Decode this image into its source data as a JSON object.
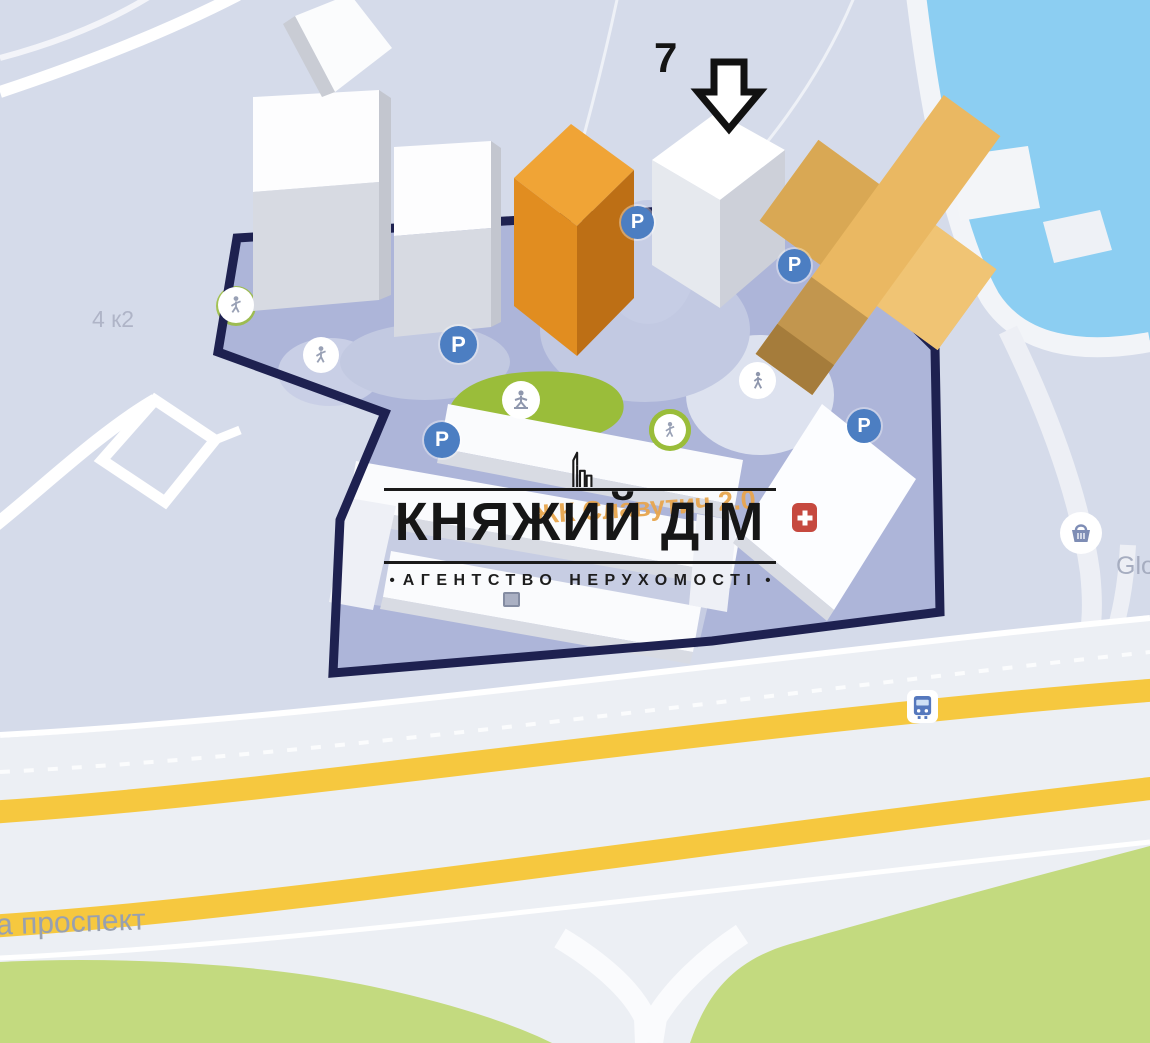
{
  "map": {
    "labels": {
      "target_number": "7",
      "building_code": "4 к2",
      "street": "а проспект",
      "store": "Glo",
      "complex": "ЖК Славутич 2.0"
    },
    "colors": {
      "water": "#8ccef2",
      "site_fill": "#adb5d9",
      "site_outline": "#1e2150",
      "highway_yellow": "#f6c83f",
      "green": "#c3da7f",
      "playground_green": "#9abd3a",
      "building_orange": "#eab862",
      "parking_blue": "#4c7ec2",
      "medical_red": "#c6493f"
    }
  },
  "icons": {
    "parking_label": "P"
  },
  "logo": {
    "title": "КНЯЖИЙ ДІМ",
    "subtitle": "АГЕНТСТВО НЕРУХОМОСТІ",
    "bullet": "•"
  }
}
